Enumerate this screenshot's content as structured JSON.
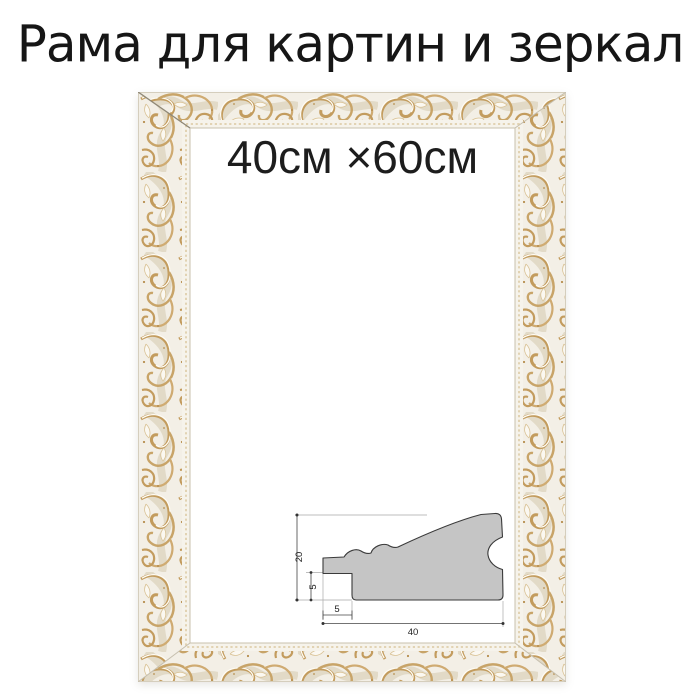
{
  "title": "Рама для картин и зеркал",
  "frame": {
    "style": "ornate baroque, white with gold accents",
    "size_label": "40см ×60см"
  },
  "diagram": {
    "type": "frame profile cross-section",
    "labels": {
      "total_height_mm": "20",
      "rebate_height_mm": "5",
      "rebate_width_mm": "5",
      "total_width_mm": "40"
    }
  },
  "colors": {
    "gold_accent": "#c29a5e",
    "frame_base": "#f3efe6",
    "profile_fill": "#c5c5c5",
    "text": "#1d1d1d"
  }
}
